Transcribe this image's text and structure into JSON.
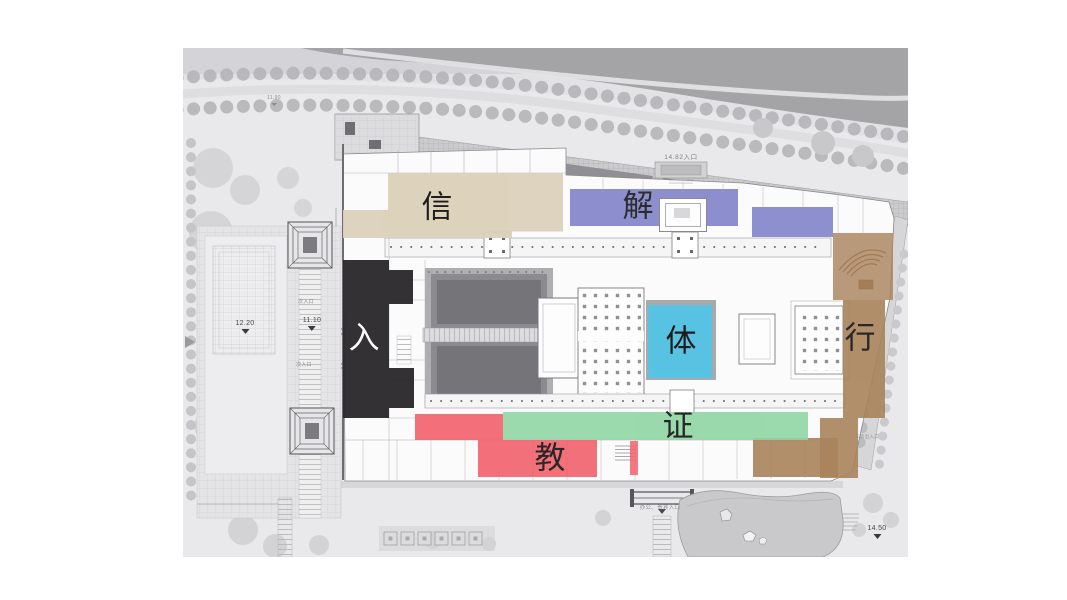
{
  "plan": {
    "type": "architectural-site-plan",
    "background_color": "#e9e9eb",
    "zones": [
      {
        "id": "xin",
        "label": "信",
        "color": "#dcd1ba",
        "label_color": "#111111"
      },
      {
        "id": "jie",
        "label": "解",
        "color": "#7e80c8",
        "label_color": "#111111"
      },
      {
        "id": "ru",
        "label": "入",
        "color": "#2b292b",
        "label_color": "#ffffff"
      },
      {
        "id": "ti",
        "label": "体",
        "color": "#53c6ea",
        "label_color": "#111111"
      },
      {
        "id": "xing",
        "label": "行",
        "color": "#a8835b",
        "label_color": "#111111"
      },
      {
        "id": "zheng",
        "label": "证",
        "color": "#90d6a4",
        "label_color": "#111111"
      },
      {
        "id": "jiao",
        "label": "教",
        "color": "#f2616d",
        "label_color": "#111111"
      }
    ],
    "annotations": {
      "elev_north_road": "11.90",
      "elev_west_plaza": "12.20",
      "elev_west_gate": "11.10",
      "north_entrance": "14.82入口",
      "elev_southeast": "14.50",
      "side_gate_upper": "次入口",
      "side_gate_lower": "次入口",
      "south_entrance": "办公、贵宾入口",
      "garage_entrance": "车房出入口"
    }
  }
}
